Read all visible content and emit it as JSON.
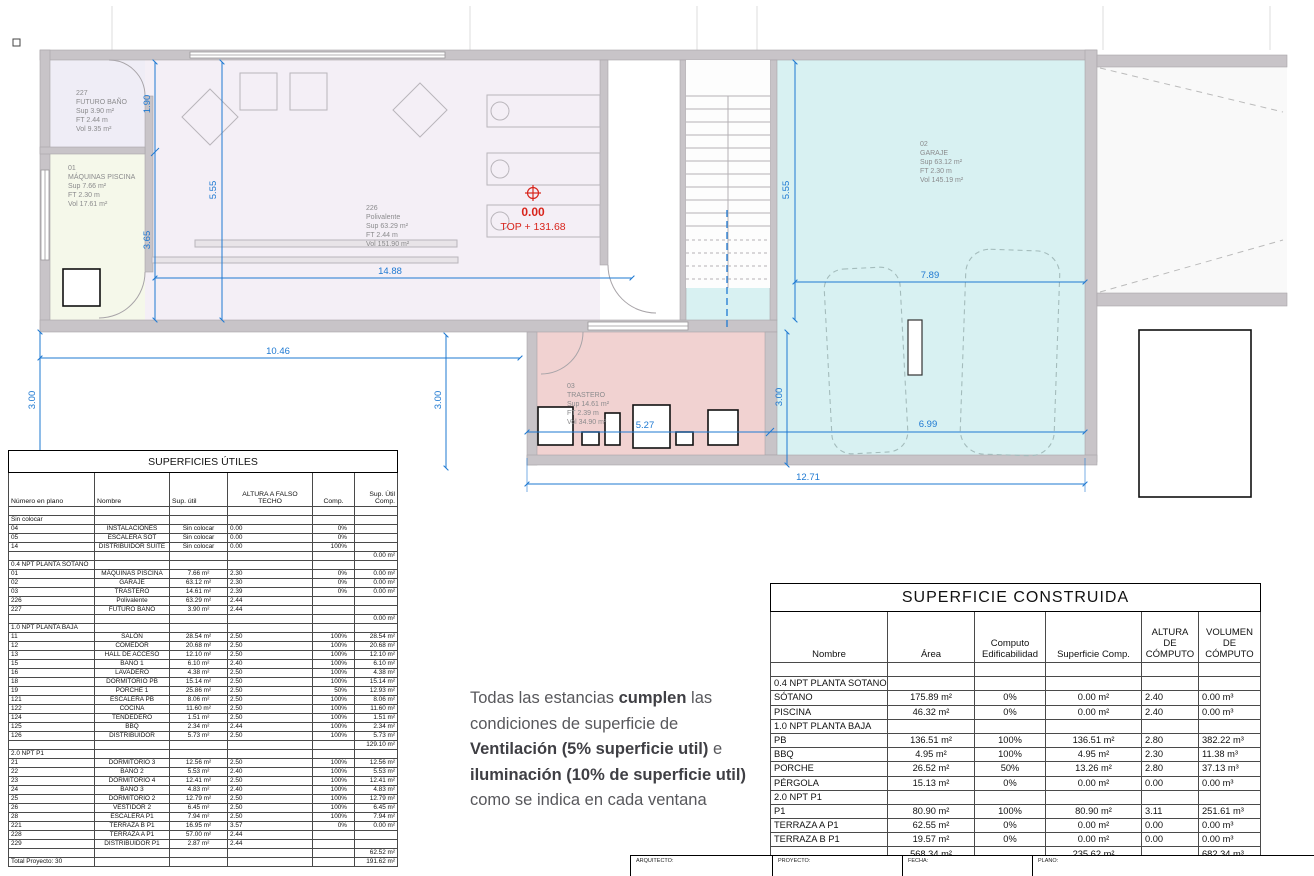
{
  "plan": {
    "rooms": [
      {
        "num": "227",
        "name": "FUTURO BAÑO",
        "sup": "Sup 3.90 m²",
        "ft": "FT 2.44 m",
        "vol": "Vol 9.35 m²"
      },
      {
        "num": "01",
        "name": "MÁQUINAS PISCINA",
        "sup": "Sup 7.66 m²",
        "ft": "FT 2.30 m",
        "vol": "Vol 17.61 m²"
      },
      {
        "num": "226",
        "name": "Polivalente",
        "sup": "Sup 63.29 m²",
        "ft": "FT 2.44 m",
        "vol": "Vol 151.90 m²"
      },
      {
        "num": "02",
        "name": "GARAJE",
        "sup": "Sup 63.12 m²",
        "ft": "FT 2.30 m",
        "vol": "Vol 145.19 m²"
      },
      {
        "num": "03",
        "name": "TRASTERO",
        "sup": "Sup 14.61 m²",
        "ft": "FT 2.39 m",
        "vol": "Vol 34.90 m²"
      }
    ],
    "level_marker": {
      "elevation": "0.00",
      "top": "TOP + 131.68"
    },
    "dims": {
      "d190": "1.90",
      "d365": "3.65",
      "d555a": "5.55",
      "d555b": "5.55",
      "d1488": "14.88",
      "d1046": "10.46",
      "d300a": "3.00",
      "d300b": "3.00",
      "d300c": "3.00",
      "d789": "7.89",
      "d699": "6.99",
      "d527": "5.27",
      "d1271": "12.71"
    },
    "colors": {
      "dim_blue": "#1e79d2",
      "wall_gray": "#c8c4c8",
      "garage_fill": "#d8f1f2",
      "trastero_fill": "#f1d2d1",
      "polivalente_fill": "#f4eff6",
      "piscina_fill": "#f5f8ea",
      "futuro_bano_fill": "#efedf6",
      "level_red": "#d8251c"
    }
  },
  "left_table": {
    "title": "SUPERFICIES ÚTILES",
    "headers": [
      "Número en plano",
      "Nombre",
      "Sup. útil",
      "ALTURA A FALSO\nTECHO",
      "Comp.",
      "Sup. Útil\nComp."
    ],
    "rows": [
      {
        "t": "b",
        "c": [
          "",
          "",
          "",
          "",
          "",
          ""
        ]
      },
      {
        "t": "s",
        "c": [
          "Sin colocar",
          "",
          "",
          "",
          "",
          ""
        ]
      },
      {
        "t": "d",
        "c": [
          "04",
          "INSTALACIONES",
          "Sin colocar",
          "0.00",
          "0%",
          ""
        ]
      },
      {
        "t": "d",
        "c": [
          "05",
          "ESCALERA SOT",
          "Sin colocar",
          "0.00",
          "0%",
          ""
        ]
      },
      {
        "t": "d",
        "c": [
          "14",
          "DISTRIBUIDOR SUITE",
          "Sin colocar",
          "0.00",
          "100%",
          ""
        ]
      },
      {
        "t": "d",
        "c": [
          "",
          "",
          "",
          "",
          "",
          "0.00 m²"
        ]
      },
      {
        "t": "s",
        "c": [
          "0.4 NPT PLANTA SOTANO",
          "",
          "",
          "",
          "",
          ""
        ]
      },
      {
        "t": "d",
        "c": [
          "01",
          "MÁQUINAS PISCINA",
          "7.66 m²",
          "2.30",
          "0%",
          "0.00 m²"
        ]
      },
      {
        "t": "d",
        "c": [
          "02",
          "GARAJE",
          "63.12 m²",
          "2.30",
          "0%",
          "0.00 m²"
        ]
      },
      {
        "t": "d",
        "c": [
          "03",
          "TRASTERO",
          "14.61 m²",
          "2.39",
          "0%",
          "0.00 m²"
        ]
      },
      {
        "t": "d",
        "c": [
          "226",
          "Polivalente",
          "63.29 m²",
          "2.44",
          "",
          ""
        ]
      },
      {
        "t": "d",
        "c": [
          "227",
          "FUTURO BAÑO",
          "3.90 m²",
          "2.44",
          "",
          ""
        ]
      },
      {
        "t": "d",
        "c": [
          "",
          "",
          "",
          "",
          "",
          "0.00 m²"
        ]
      },
      {
        "t": "s",
        "c": [
          "1.0 NPT PLANTA BAJA",
          "",
          "",
          "",
          "",
          ""
        ]
      },
      {
        "t": "d",
        "c": [
          "11",
          "SALÓN",
          "28.54 m²",
          "2.50",
          "100%",
          "28.54 m²"
        ]
      },
      {
        "t": "d",
        "c": [
          "12",
          "COMEDOR",
          "20.68 m²",
          "2.50",
          "100%",
          "20.68 m²"
        ]
      },
      {
        "t": "d",
        "c": [
          "13",
          "HALL DE ACCESO",
          "12.10 m²",
          "2.50",
          "100%",
          "12.10 m²"
        ]
      },
      {
        "t": "d",
        "c": [
          "15",
          "BAÑO 1",
          "6.10 m²",
          "2.40",
          "100%",
          "6.10 m²"
        ]
      },
      {
        "t": "d",
        "c": [
          "16",
          "LAVADERO",
          "4.38 m²",
          "2.50",
          "100%",
          "4.38 m²"
        ]
      },
      {
        "t": "d",
        "c": [
          "18",
          "DORMITORIO PB",
          "15.14 m²",
          "2.50",
          "100%",
          "15.14 m²"
        ]
      },
      {
        "t": "d",
        "c": [
          "19",
          "PORCHE 1",
          "25.86 m²",
          "2.50",
          "50%",
          "12.93 m²"
        ]
      },
      {
        "t": "d",
        "c": [
          "121",
          "ESCALERA PB",
          "8.06 m²",
          "2.50",
          "100%",
          "8.06 m²"
        ]
      },
      {
        "t": "d",
        "c": [
          "122",
          "COCINA",
          "11.60 m²",
          "2.50",
          "100%",
          "11.60 m²"
        ]
      },
      {
        "t": "d",
        "c": [
          "124",
          "TENDEDERO",
          "1.51 m²",
          "2.50",
          "100%",
          "1.51 m²"
        ]
      },
      {
        "t": "d",
        "c": [
          "125",
          "BBQ",
          "2.34 m²",
          "2.44",
          "100%",
          "2.34 m²"
        ]
      },
      {
        "t": "d",
        "c": [
          "126",
          "DISTRIBUIDOR",
          "5.73 m²",
          "2.50",
          "100%",
          "5.73 m²"
        ]
      },
      {
        "t": "d",
        "c": [
          "",
          "",
          "",
          "",
          "",
          "129.10 m²"
        ]
      },
      {
        "t": "s",
        "c": [
          "2.0 NPT P1",
          "",
          "",
          "",
          "",
          ""
        ]
      },
      {
        "t": "d",
        "c": [
          "21",
          "DORMITORIO 3",
          "12.56 m²",
          "2.50",
          "100%",
          "12.56 m²"
        ]
      },
      {
        "t": "d",
        "c": [
          "22",
          "BAÑO 2",
          "5.53 m²",
          "2.40",
          "100%",
          "5.53 m²"
        ]
      },
      {
        "t": "d",
        "c": [
          "23",
          "DORMITORIO 4",
          "12.41 m²",
          "2.50",
          "100%",
          "12.41 m²"
        ]
      },
      {
        "t": "d",
        "c": [
          "24",
          "BAÑO 3",
          "4.83 m²",
          "2.40",
          "100%",
          "4.83 m²"
        ]
      },
      {
        "t": "d",
        "c": [
          "25",
          "DORMITORIO 2",
          "12.79 m²",
          "2.50",
          "100%",
          "12.79 m²"
        ]
      },
      {
        "t": "d",
        "c": [
          "26",
          "VESTIDOR 2",
          "6.45 m²",
          "2.50",
          "100%",
          "6.45 m²"
        ]
      },
      {
        "t": "d",
        "c": [
          "28",
          "ESCALERA P1",
          "7.94 m²",
          "2.50",
          "100%",
          "7.94 m²"
        ]
      },
      {
        "t": "d",
        "c": [
          "221",
          "TERRAZA B P1",
          "16.95 m²",
          "3.57",
          "0%",
          "0.00 m²"
        ]
      },
      {
        "t": "d",
        "c": [
          "228",
          "TERRAZA A P1",
          "57.00 m²",
          "2.44",
          "",
          ""
        ]
      },
      {
        "t": "d",
        "c": [
          "229",
          "DISTRIBUIDOR P1",
          "2.87 m²",
          "2.44",
          "",
          ""
        ]
      },
      {
        "t": "d",
        "c": [
          "",
          "",
          "",
          "",
          "",
          "62.52 m²"
        ]
      },
      {
        "t": "d",
        "c": [
          "Total Proyecto: 30",
          "",
          "",
          "",
          "",
          "191.62 m²"
        ]
      }
    ]
  },
  "right_table": {
    "title": "SUPERFICIE CONSTRUIDA",
    "headers": [
      "Nombre",
      "Área",
      "Computo\nEdificabilidad",
      "Superficie Comp.",
      "ALTURA DE\nCÓMPUTO",
      "VOLUMEN\nDE\nCÓMPUTO"
    ],
    "rows": [
      {
        "t": "b",
        "c": [
          "",
          "",
          "",
          "",
          "",
          ""
        ]
      },
      {
        "t": "s",
        "c": [
          "0.4 NPT PLANTA SOTANO",
          "",
          "",
          "",
          "",
          ""
        ]
      },
      {
        "t": "d",
        "c": [
          "SÓTANO",
          "175.89 m²",
          "0%",
          "0.00 m²",
          "2.40",
          "0.00 m³"
        ]
      },
      {
        "t": "d",
        "c": [
          "PISCINA",
          "46.32 m²",
          "0%",
          "0.00 m²",
          "2.40",
          "0.00 m³"
        ]
      },
      {
        "t": "s",
        "c": [
          "1.0 NPT PLANTA BAJA",
          "",
          "",
          "",
          "",
          ""
        ]
      },
      {
        "t": "d",
        "c": [
          "PB",
          "136.51 m²",
          "100%",
          "136.51 m²",
          "2.80",
          "382.22 m³"
        ]
      },
      {
        "t": "d",
        "c": [
          "BBQ",
          "4.95 m²",
          "100%",
          "4.95 m²",
          "2.30",
          "11.38 m³"
        ]
      },
      {
        "t": "d",
        "c": [
          "PORCHE",
          "26.52 m²",
          "50%",
          "13.26 m²",
          "2.80",
          "37.13 m³"
        ]
      },
      {
        "t": "d",
        "c": [
          "PÉRGOLA",
          "15.13 m²",
          "0%",
          "0.00 m²",
          "0.00",
          "0.00 m³"
        ]
      },
      {
        "t": "s",
        "c": [
          "2.0 NPT P1",
          "",
          "",
          "",
          "",
          ""
        ]
      },
      {
        "t": "d",
        "c": [
          "P1",
          "80.90 m²",
          "100%",
          "80.90 m²",
          "3.11",
          "251.61 m³"
        ]
      },
      {
        "t": "d",
        "c": [
          "TERRAZA A P1",
          "62.55 m²",
          "0%",
          "0.00 m²",
          "0.00",
          "0.00 m³"
        ]
      },
      {
        "t": "d",
        "c": [
          "TERRAZA B P1",
          "19.57 m²",
          "0%",
          "0.00 m²",
          "0.00",
          "0.00 m³"
        ]
      },
      {
        "t": "d",
        "c": [
          "",
          "568.34 m²",
          "",
          "235.62 m²",
          "",
          "682.34 m³"
        ]
      }
    ]
  },
  "note": {
    "l1a": "Todas las estancias ",
    "l1b": "cumplen",
    "l1c": " las",
    "l2": "condiciones de superficie de",
    "l3a": "Ventilación (5% superficie util)",
    "l3b": " e",
    "l4": "iluminación (10% de superficie util)",
    "l5": "como se indica en cada ventana"
  },
  "title_block": {
    "labels": [
      "ARQUITECTO:",
      "PROYECTO:",
      "FECHA:",
      "PLANO:"
    ]
  }
}
